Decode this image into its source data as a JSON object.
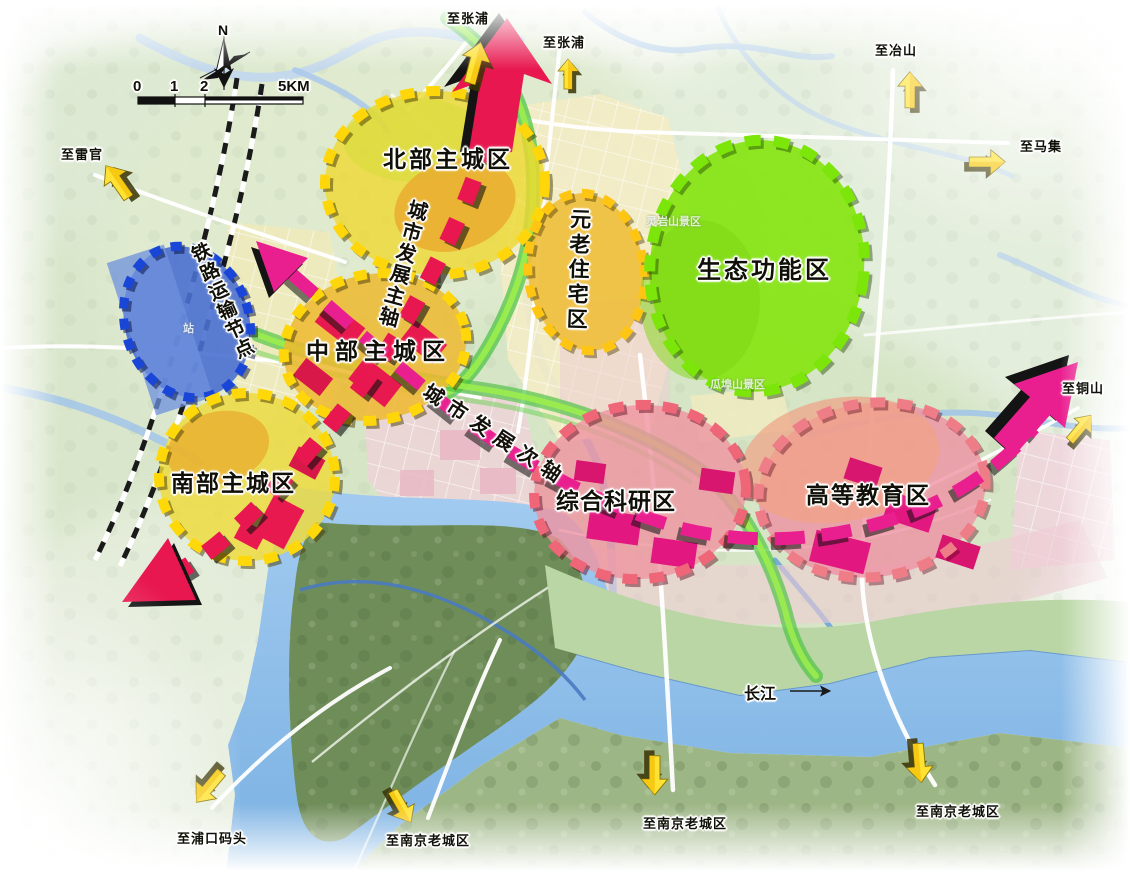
{
  "compass": {
    "north": "N"
  },
  "scale_bar": {
    "tick0": "0",
    "tick1": "1",
    "tick2": "2",
    "tick_end": "5KM"
  },
  "zones": [
    {
      "id": "north-main-city",
      "label": "北部主城区",
      "fill": "#eed831",
      "border": "#ffd60a"
    },
    {
      "id": "central-main-city",
      "label": "中部主城区",
      "fill": "#edb92f",
      "border": "#ffd60a"
    },
    {
      "id": "south-main-city",
      "label": "南部主城区",
      "fill": "#eeda3b",
      "border": "#ffd80a"
    },
    {
      "id": "elder-residential",
      "label": "元老住宅区",
      "fill": "#eebe3a",
      "border": "#ffc513"
    },
    {
      "id": "eco-function",
      "label": "生态功能区",
      "fill": "#8ae41b",
      "border": "#7ce60a"
    },
    {
      "id": "railway-node",
      "label": "铁路运输节点",
      "fill": "#4a70cf",
      "border": "#1a46d8"
    },
    {
      "id": "research",
      "label": "综合科研区",
      "fill": "#ef93a0",
      "border": "#ee6677"
    },
    {
      "id": "higher-education",
      "label": "高等教育区",
      "fill": "#ef9a8e",
      "border": "#ee7d87"
    }
  ],
  "axes": [
    {
      "id": "main-axis",
      "label": "城市发展主轴",
      "color": "#e8174f"
    },
    {
      "id": "secondary-axis",
      "label": "城市发展次轴",
      "color": "#ea1f8f"
    }
  ],
  "edge_labels": [
    {
      "id": "zhangpu-west",
      "label": "至张浦"
    },
    {
      "id": "zhangpu-east",
      "label": "至张浦"
    },
    {
      "id": "yeshan",
      "label": "至冶山"
    },
    {
      "id": "maji",
      "label": "至马集"
    },
    {
      "id": "leiguan",
      "label": "至雷官"
    },
    {
      "id": "tongshan",
      "label": "至铜山"
    },
    {
      "id": "pukou-wharf",
      "label": "至浦口码头"
    },
    {
      "id": "nanjing-southwest",
      "label": "至南京老城区"
    },
    {
      "id": "nanjing-south",
      "label": "至南京老城区"
    },
    {
      "id": "nanjing-southeast",
      "label": "至南京老城区"
    }
  ],
  "map_labels": {
    "river": "长江",
    "scenic_north": "灵岩山景区",
    "scenic_south": "瓜埠山景区",
    "station": "站"
  },
  "colors": {
    "main_axis": "#e8174f",
    "secondary_axis": "#ea1f8f",
    "zone_yellow": "#f0d92e",
    "zone_green": "#8ae41b",
    "zone_blue": "#3f66cc",
    "zone_pink": "#ef8fa0",
    "edge_arrow": "#ffe233",
    "river_blue": "#8fc0ea"
  }
}
